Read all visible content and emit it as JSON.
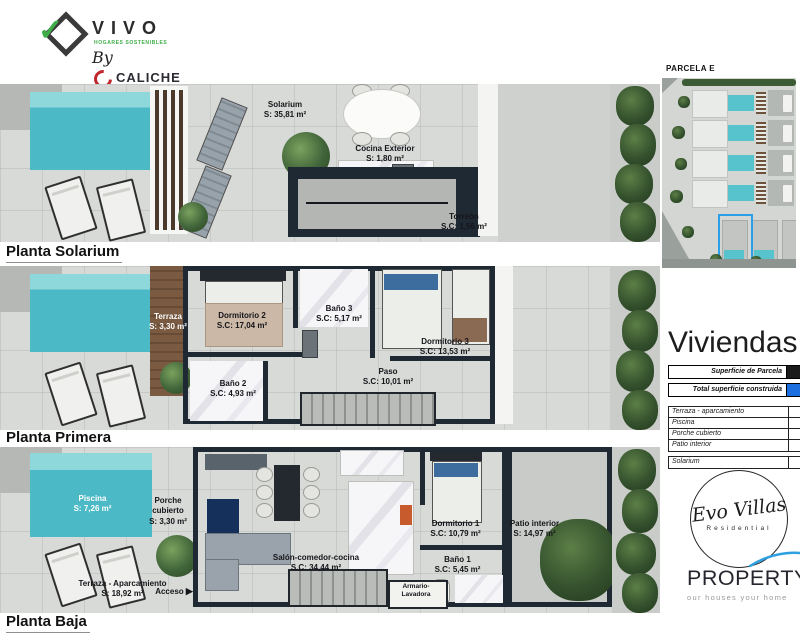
{
  "logo_vivo": {
    "name": "VIVO",
    "tagline": "HOGARES SOSTENIBLES",
    "by": "By",
    "caliche": "CALICHE",
    "caliche_tagline": "CORPORACIÓN FAMILIAR"
  },
  "plans": [
    {
      "label": "Planta Solarium",
      "rooms": {
        "solarium": {
          "name": "Solarium",
          "area": "S: 35,81 m²"
        },
        "cocina": {
          "name": "Cocina Exterior",
          "area": "S: 1,80 m²"
        },
        "torreon": {
          "name": "Torreón",
          "area": "S.C: 1,56 m²"
        }
      }
    },
    {
      "label": "Planta Primera",
      "rooms": {
        "terraza": {
          "name": "Terraza",
          "area": "S: 3,30 m²"
        },
        "dormitorio2": {
          "name": "Dormitorio 2",
          "area": "S.C: 17,04 m²"
        },
        "bano3": {
          "name": "Baño 3",
          "area": "S.C: 5,17 m²"
        },
        "dormitorio3": {
          "name": "Dormitorio 3",
          "area": "S.C: 13,53 m²"
        },
        "bano2": {
          "name": "Baño 2",
          "area": "S.C: 4,93 m²"
        },
        "paso": {
          "name": "Paso",
          "area": "S.C: 10,01 m²"
        }
      }
    },
    {
      "label": "Planta Baja",
      "rooms": {
        "piscina": {
          "name": "Piscina",
          "area": "S: 7,26 m²"
        },
        "porche": {
          "name": "Porche cubierto",
          "area": "S: 3,30 m²"
        },
        "terraza": {
          "name": "Terraza - Aparcamiento",
          "area": "S: 18,92 m²"
        },
        "acceso": {
          "name": "Acceso",
          "area": ""
        },
        "salon": {
          "name": "Salón-comedor-cocina",
          "area": "S.C: 34,44 m²"
        },
        "dormitorio1": {
          "name": "Dormitorio 1",
          "area": "S.C: 10,79 m²"
        },
        "bano1": {
          "name": "Baño 1",
          "area": "S.C: 5,45 m²"
        },
        "armario": {
          "name": "Armario-Lavadora",
          "area": ""
        },
        "patio": {
          "name": "Patio interior",
          "area": "S: 14,97 m²"
        }
      }
    }
  ],
  "sidebar": {
    "parcela_label": "PARCELA E",
    "title": "Viviendas 5-6-7",
    "table": {
      "summary_rows": [
        {
          "label": "Superficie de Parcela"
        },
        {
          "label": "Total superficie construida"
        }
      ],
      "rows": [
        {
          "label": "Terraza - aparcamiento"
        },
        {
          "label": "Piscina"
        },
        {
          "label": "Porche cubierto"
        },
        {
          "label": "Patio interior"
        },
        {
          "label": "Solarium"
        }
      ]
    },
    "evo": {
      "name": "Evo Villas",
      "sub": "Residential"
    },
    "property": {
      "name": "PROPERTY",
      "suffix": "&CO",
      "tagline": "our houses your home"
    }
  },
  "colors": {
    "accent_blue": "#2e9fe0",
    "table_blue": "#1d6fe0",
    "wall_dark": "#1f2933",
    "pool_teal": "#4cbac6",
    "brand_green": "#3fae49",
    "brand_red": "#c0272d"
  }
}
